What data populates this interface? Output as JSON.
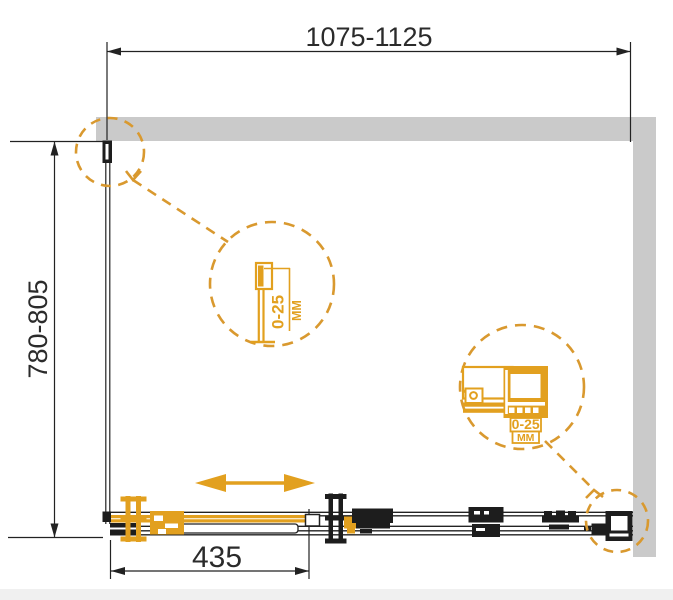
{
  "drawing": {
    "type": "technical-drawing",
    "subject": "shower-enclosure-plan-view",
    "dimensions": {
      "width_range": "1075-1125",
      "depth_range": "780-805",
      "door_width": "435"
    },
    "details": {
      "side_wall_profile": {
        "range": "0-25",
        "unit": "MM"
      },
      "front_wall_profile": {
        "range": "0-25",
        "unit": "MM"
      }
    },
    "colors": {
      "accent_orange": "#E2A01F",
      "dashed_orange": "#D9992F",
      "wall_gray": "#CACACA",
      "line_black": "#222222"
    }
  }
}
